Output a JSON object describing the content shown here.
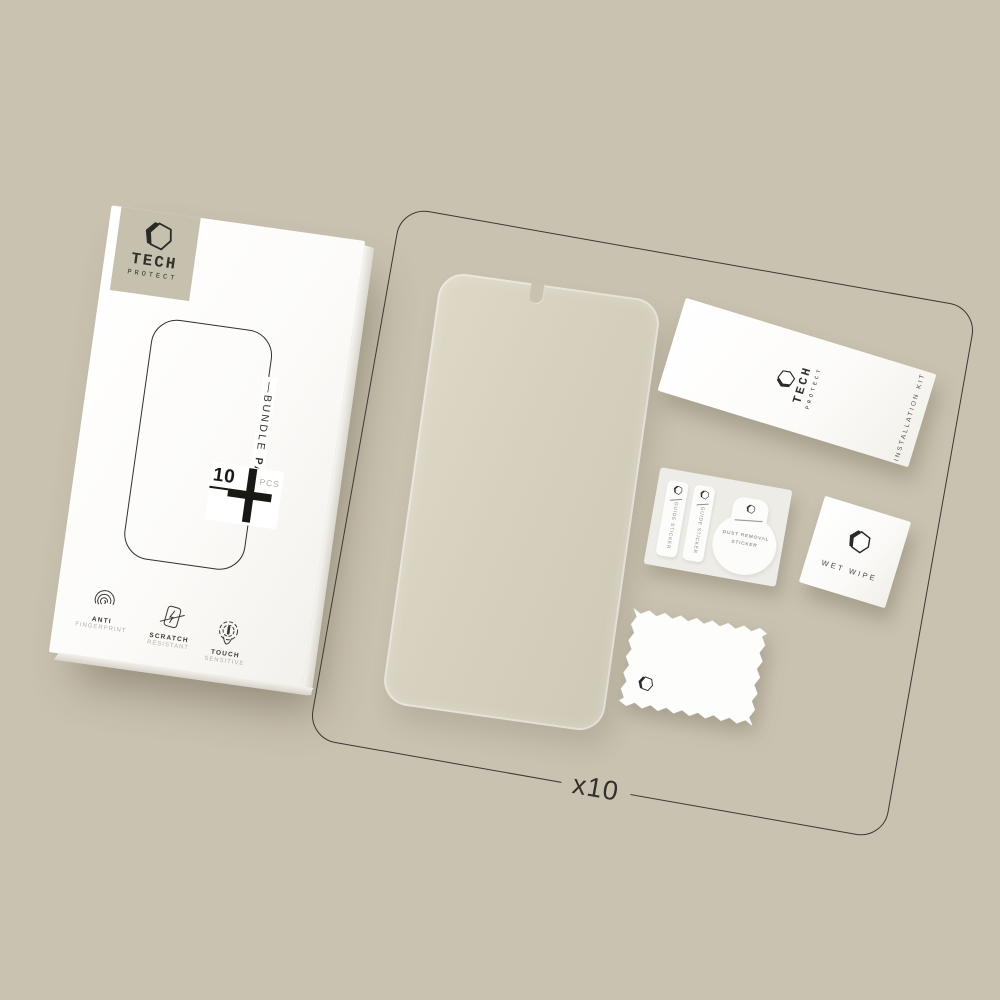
{
  "colors": {
    "background": "#c9c2b0",
    "surface_white": "#fdfdfc",
    "line_dark": "#32302b",
    "badge_beige": "#c6c0ae",
    "muted_gray": "#b4b1a9",
    "glass_tint": "#d6d0bf"
  },
  "box": {
    "logo": {
      "icon": "hexagon-logo-icon",
      "line1": "TECH",
      "line2": "PROTECT"
    },
    "bundle": {
      "dash": "—",
      "word1": "BUNDLE",
      "word2": "PACK"
    },
    "count": {
      "number": "10",
      "unit": "PCS"
    },
    "features": [
      {
        "icon": "fingerprint-icon",
        "line1": "ANTI",
        "line2": "FINGERPRINT"
      },
      {
        "icon": "scratch-icon",
        "line1": "SCRATCH",
        "line2": "RESISTANT"
      },
      {
        "icon": "touch-icon",
        "line1": "TOUCH",
        "line2": "SENSITIVE"
      }
    ]
  },
  "kit": {
    "installation_card": {
      "logo_line1": "TECH",
      "logo_line2": "PROTECT",
      "side_label": "INSTALLATION KIT"
    },
    "sticker_sheet": {
      "guide_sticker_1": "GUIDE STICKER",
      "guide_sticker_2": "GUIDE STICKER",
      "dust_sticker": {
        "line1": "DUST REMOVAL",
        "line2": "STICKER"
      }
    },
    "wet_wipe": {
      "label": "WET WIPE"
    },
    "quantity": "x10"
  }
}
